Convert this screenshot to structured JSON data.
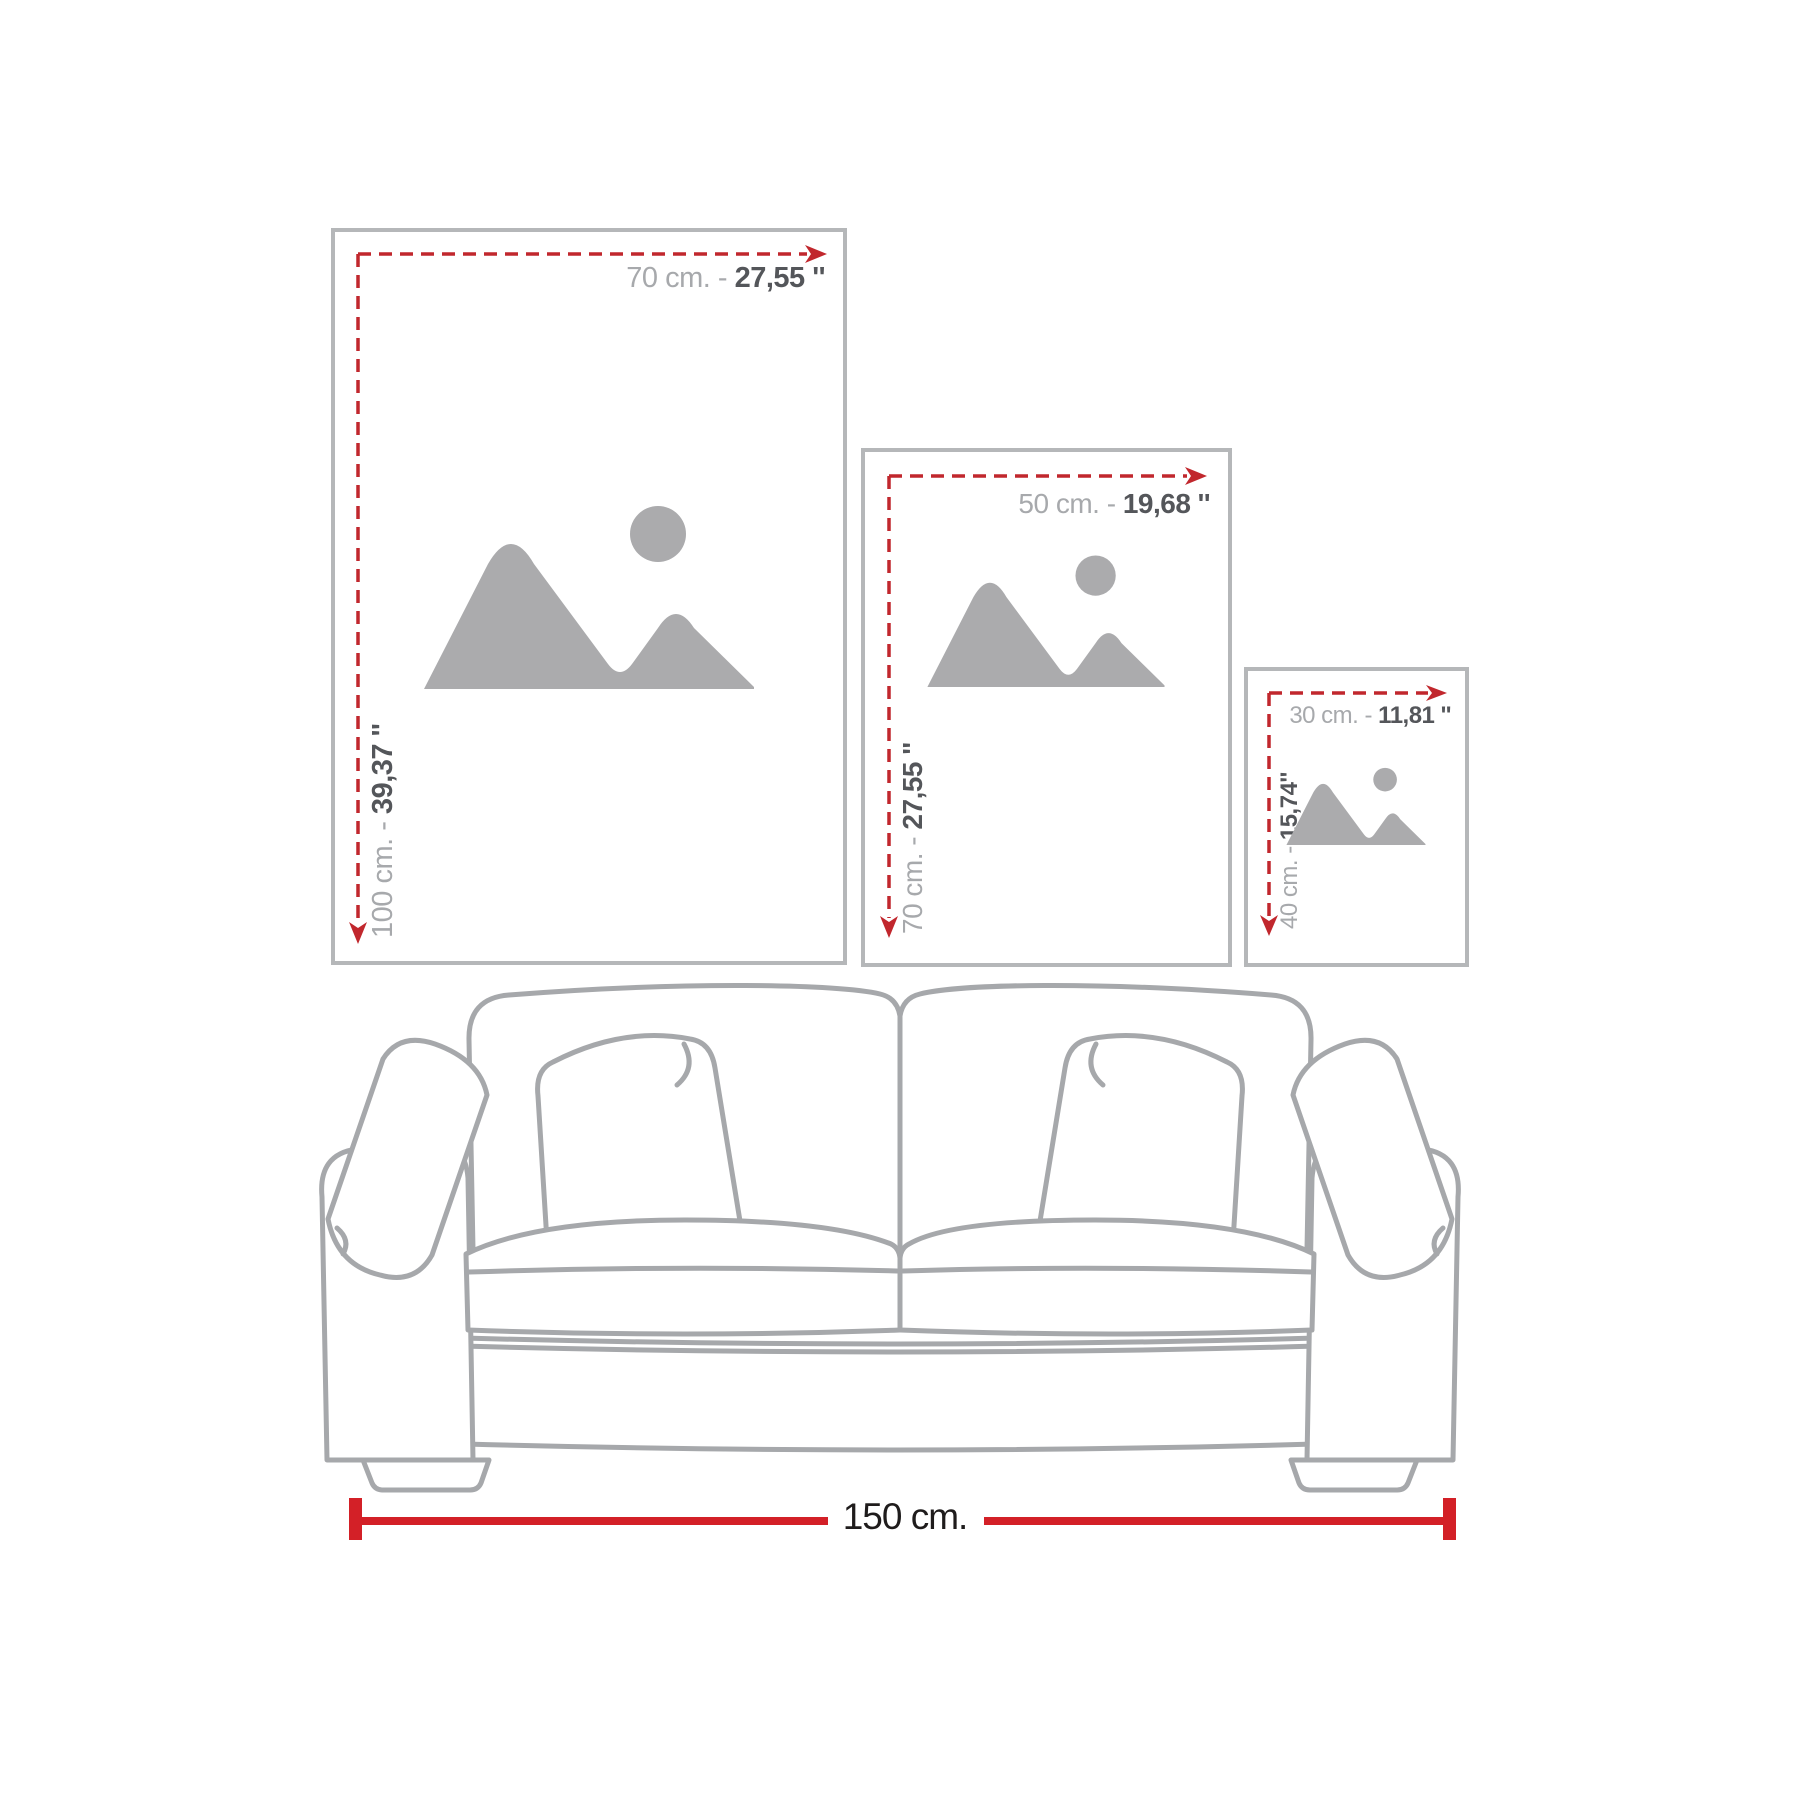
{
  "canvas": {
    "width": 1800,
    "height": 1800,
    "background": "#ffffff"
  },
  "colors": {
    "frameBorder": "#b5b7b9",
    "dashRed": "#c1272d",
    "solidRed": "#d32027",
    "labelLight": "#a7a9ac",
    "labelDark": "#54565a",
    "iconGray": "#ababad",
    "sofaOutline": "#a6a8ab",
    "dimensionText": "#1f1c1c"
  },
  "frames": [
    {
      "id": "large",
      "width_cm": "70 cm. -",
      "width_in": "27,55 ''",
      "height_cm": "100 cm. -",
      "height_in": "39,37 ''"
    },
    {
      "id": "medium",
      "width_cm": "50 cm. -",
      "width_in": "19,68 ''",
      "height_cm": "70 cm. -",
      "height_in": "27,55 ''"
    },
    {
      "id": "small",
      "width_cm": "30 cm. -",
      "width_in": "11,81 ''",
      "height_cm": "40 cm. -",
      "height_in": "15,74''"
    }
  ],
  "sofa": {
    "width_label": "150 cm."
  },
  "icons": {
    "placeholder": "image-placeholder-icon"
  }
}
